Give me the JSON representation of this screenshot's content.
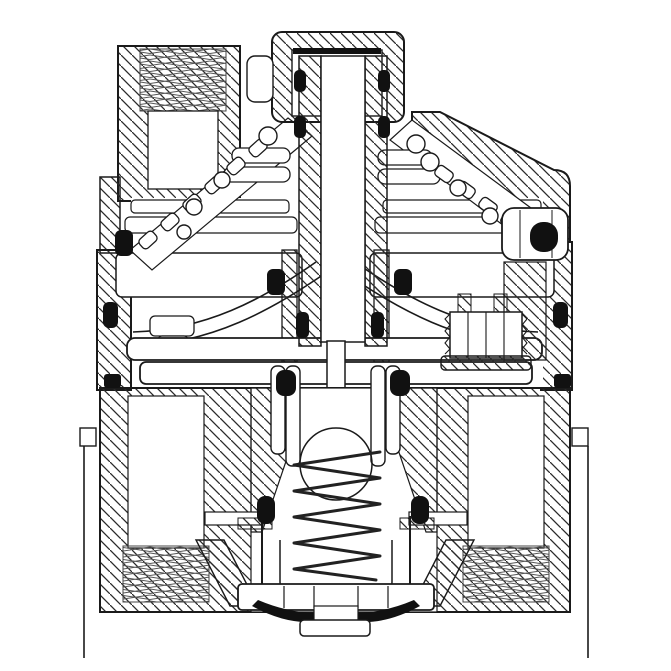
{
  "figure": {
    "subject": "Pressure regulator valve cross-section technical drawing",
    "colors": {
      "background": "#ffffff",
      "line": "#1a1a1a",
      "hatch": "#2a2a2a",
      "thread": "#565656",
      "seal": "#111111"
    },
    "components": [
      {
        "id": "adjusting-cap",
        "label": "adjusting cap"
      },
      {
        "id": "adjusting-stem",
        "label": "adjusting screw stem"
      },
      {
        "id": "top-threaded-port",
        "label": "top threaded spring-chamber port"
      },
      {
        "id": "right-shoulder",
        "label": "sloped bonnet shoulder"
      },
      {
        "id": "lever-spring-chains",
        "label": "angled coil spring passages"
      },
      {
        "id": "diaphragm-stack",
        "label": "diaphragm plate stack"
      },
      {
        "id": "pilot-poppet",
        "label": "pilot poppet with seal"
      },
      {
        "id": "pilot-screw",
        "label": "threaded pilot screw"
      },
      {
        "id": "valve-body",
        "label": "lower valve body"
      },
      {
        "id": "inlet-port",
        "label": "threaded inlet port"
      },
      {
        "id": "outlet-port",
        "label": "threaded outlet port"
      },
      {
        "id": "cone-springs",
        "label": "conical return springs"
      },
      {
        "id": "main-spring",
        "label": "main coil spring"
      },
      {
        "id": "spring-cup",
        "label": "spring retainer cup"
      },
      {
        "id": "valve-seat",
        "label": "valve seat disc"
      },
      {
        "id": "seat-seals",
        "label": "black crescent seat seals"
      },
      {
        "id": "o-ring-seals",
        "label": "O-ring seals"
      }
    ],
    "seals": [
      [
        294,
        70,
        12,
        22,
        5
      ],
      [
        378,
        70,
        12,
        22,
        5
      ],
      [
        294,
        116,
        12,
        22,
        5
      ],
      [
        378,
        116,
        12,
        22,
        5
      ],
      [
        296,
        312,
        13,
        26,
        5
      ],
      [
        371,
        312,
        13,
        26,
        5
      ],
      [
        115,
        230,
        18,
        26,
        6
      ],
      [
        530,
        222,
        28,
        30,
        13
      ],
      [
        103,
        302,
        15,
        26,
        6
      ],
      [
        553,
        302,
        15,
        26,
        6
      ],
      [
        267,
        269,
        18,
        26,
        6
      ],
      [
        394,
        269,
        18,
        26,
        6
      ],
      [
        276,
        370,
        20,
        26,
        8
      ],
      [
        390,
        370,
        20,
        26,
        8
      ],
      [
        104,
        374,
        17,
        14,
        3
      ],
      [
        554,
        374,
        17,
        14,
        3
      ],
      [
        257,
        496,
        18,
        28,
        8
      ],
      [
        411,
        496,
        18,
        28,
        8
      ]
    ]
  }
}
